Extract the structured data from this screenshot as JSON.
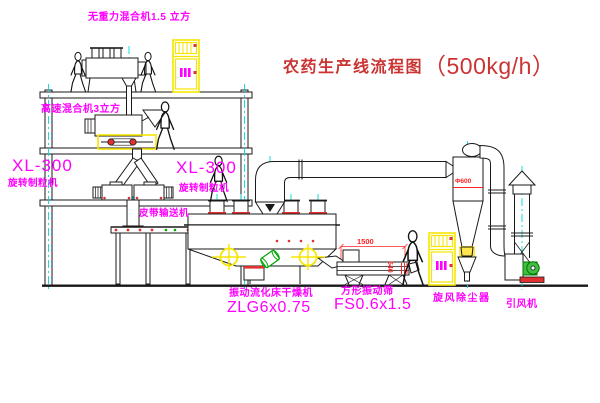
{
  "title": {
    "text": "农药生产线流程图",
    "capacity": "（500kg/h）"
  },
  "equipment_labels": {
    "gravity_mixer": "无重力混合机1.5 立方",
    "high_speed_mixer": "高速混合机3立方",
    "granulator_left_model": "XL-300",
    "granulator_left_name": "旋转制粒机",
    "granulator_center_model": "XL-300",
    "granulator_center_name": "旋转制粒机",
    "belt_conveyor": "皮带输送机",
    "dryer_name": "振动流化床干燥机",
    "dryer_model": "ZLG6x0.75",
    "sieve_name": "方形振动筛",
    "sieve_model": "FS0.6x1.5",
    "cyclone": "旋风除尘器",
    "induced_draft_fan": "引风机"
  },
  "dimensions": {
    "sieve_length": "1500",
    "cyclone_diameter": "Φ600",
    "discharge_height": "540"
  },
  "colors": {
    "label_magenta": "#FF00FF",
    "title_red": "#CC3333",
    "dimension_red": "#FF2222",
    "highlight_yellow": "#F5E600",
    "centerline_cyan": "#00D8D8",
    "accent_green": "#00A800",
    "line_black": "#1A1A1A"
  }
}
